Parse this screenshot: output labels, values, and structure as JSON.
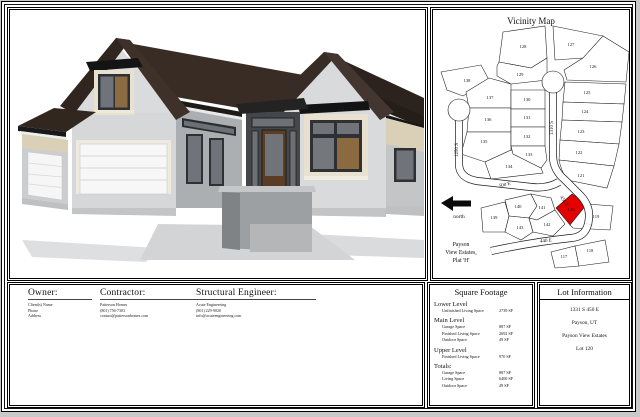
{
  "vicinity_map": {
    "title": "Vicinity Map",
    "north_label": "north",
    "plat_lines": [
      "Payson",
      "View Estates,",
      "Plat 'H'"
    ],
    "highlight_color": "#e40000",
    "highlighted_lot": "120",
    "streets": [
      {
        "label": "1250 S",
        "x": 25,
        "y": 140,
        "rot": -90
      },
      {
        "label": "1310 S",
        "x": 120,
        "y": 118,
        "rot": -90
      },
      {
        "label": "500 E",
        "x": 72,
        "y": 176,
        "rot": -12
      },
      {
        "label": "450 E",
        "x": 130,
        "y": 192,
        "rot": 58
      },
      {
        "label": "440 E",
        "x": 113,
        "y": 232,
        "rot": -6
      }
    ],
    "lots": [
      {
        "n": "128",
        "x": 90,
        "y": 38
      },
      {
        "n": "129",
        "x": 87,
        "y": 66
      },
      {
        "n": "127",
        "x": 138,
        "y": 36
      },
      {
        "n": "126",
        "x": 160,
        "y": 58
      },
      {
        "n": "138",
        "x": 34,
        "y": 72
      },
      {
        "n": "137",
        "x": 57,
        "y": 89
      },
      {
        "n": "130",
        "x": 94,
        "y": 91
      },
      {
        "n": "125",
        "x": 154,
        "y": 84
      },
      {
        "n": "136",
        "x": 55,
        "y": 111
      },
      {
        "n": "131",
        "x": 94,
        "y": 109
      },
      {
        "n": "124",
        "x": 152,
        "y": 103
      },
      {
        "n": "132",
        "x": 94,
        "y": 128
      },
      {
        "n": "123",
        "x": 148,
        "y": 123
      },
      {
        "n": "135",
        "x": 51,
        "y": 133
      },
      {
        "n": "133",
        "x": 96,
        "y": 146
      },
      {
        "n": "134",
        "x": 76,
        "y": 158
      },
      {
        "n": "122",
        "x": 146,
        "y": 144
      },
      {
        "n": "121",
        "x": 148,
        "y": 167
      },
      {
        "n": "120",
        "x": 138,
        "y": 201
      },
      {
        "n": "119",
        "x": 163,
        "y": 208
      },
      {
        "n": "140",
        "x": 85,
        "y": 198
      },
      {
        "n": "141",
        "x": 109,
        "y": 199
      },
      {
        "n": "139",
        "x": 61,
        "y": 209
      },
      {
        "n": "143",
        "x": 87,
        "y": 219
      },
      {
        "n": "142",
        "x": 114,
        "y": 216
      },
      {
        "n": "117",
        "x": 131,
        "y": 248
      },
      {
        "n": "118",
        "x": 157,
        "y": 242
      }
    ]
  },
  "owner": {
    "heading": "Owner:",
    "lines": [
      "Client(s) Name",
      "Phone",
      "Address"
    ]
  },
  "contractor": {
    "heading": "Contractor:",
    "lines": [
      "Patterson Homes",
      "(801) 756-7303",
      "contact@pattersonhomes.com"
    ]
  },
  "engineer": {
    "heading": "Structural Engineer:",
    "lines": [
      "Acute Engineering",
      "(801) 229-9020",
      "info@acuteengineering.com"
    ]
  },
  "square_footage": {
    "title": "Square Footage",
    "sections": [
      {
        "name": "Lower Level",
        "rows": [
          {
            "label": "Unfinished Living Space",
            "value": "2739 SF"
          }
        ]
      },
      {
        "name": "Main Level",
        "rows": [
          {
            "label": "Garage Space",
            "value": "887 SF"
          },
          {
            "label": "Finished Living Space",
            "value": "2692 SF"
          },
          {
            "label": "Outdoor Space",
            "value": "49 SF"
          }
        ]
      },
      {
        "name": "Upper Level",
        "rows": [
          {
            "label": "Finished Living Space",
            "value": "970 SF"
          }
        ]
      },
      {
        "name": "Totals:",
        "rows": [
          {
            "label": "Garage Space",
            "value": "887 SF"
          },
          {
            "label": "Living Space",
            "value": "6400 SF"
          },
          {
            "label": "Outdoor Space",
            "value": "49 SF"
          }
        ]
      }
    ]
  },
  "lot_information": {
    "title": "Lot Information",
    "lines": [
      "1331 S 450 E",
      "Payson, UT",
      "Payson View Estates",
      "Lot 120"
    ]
  }
}
